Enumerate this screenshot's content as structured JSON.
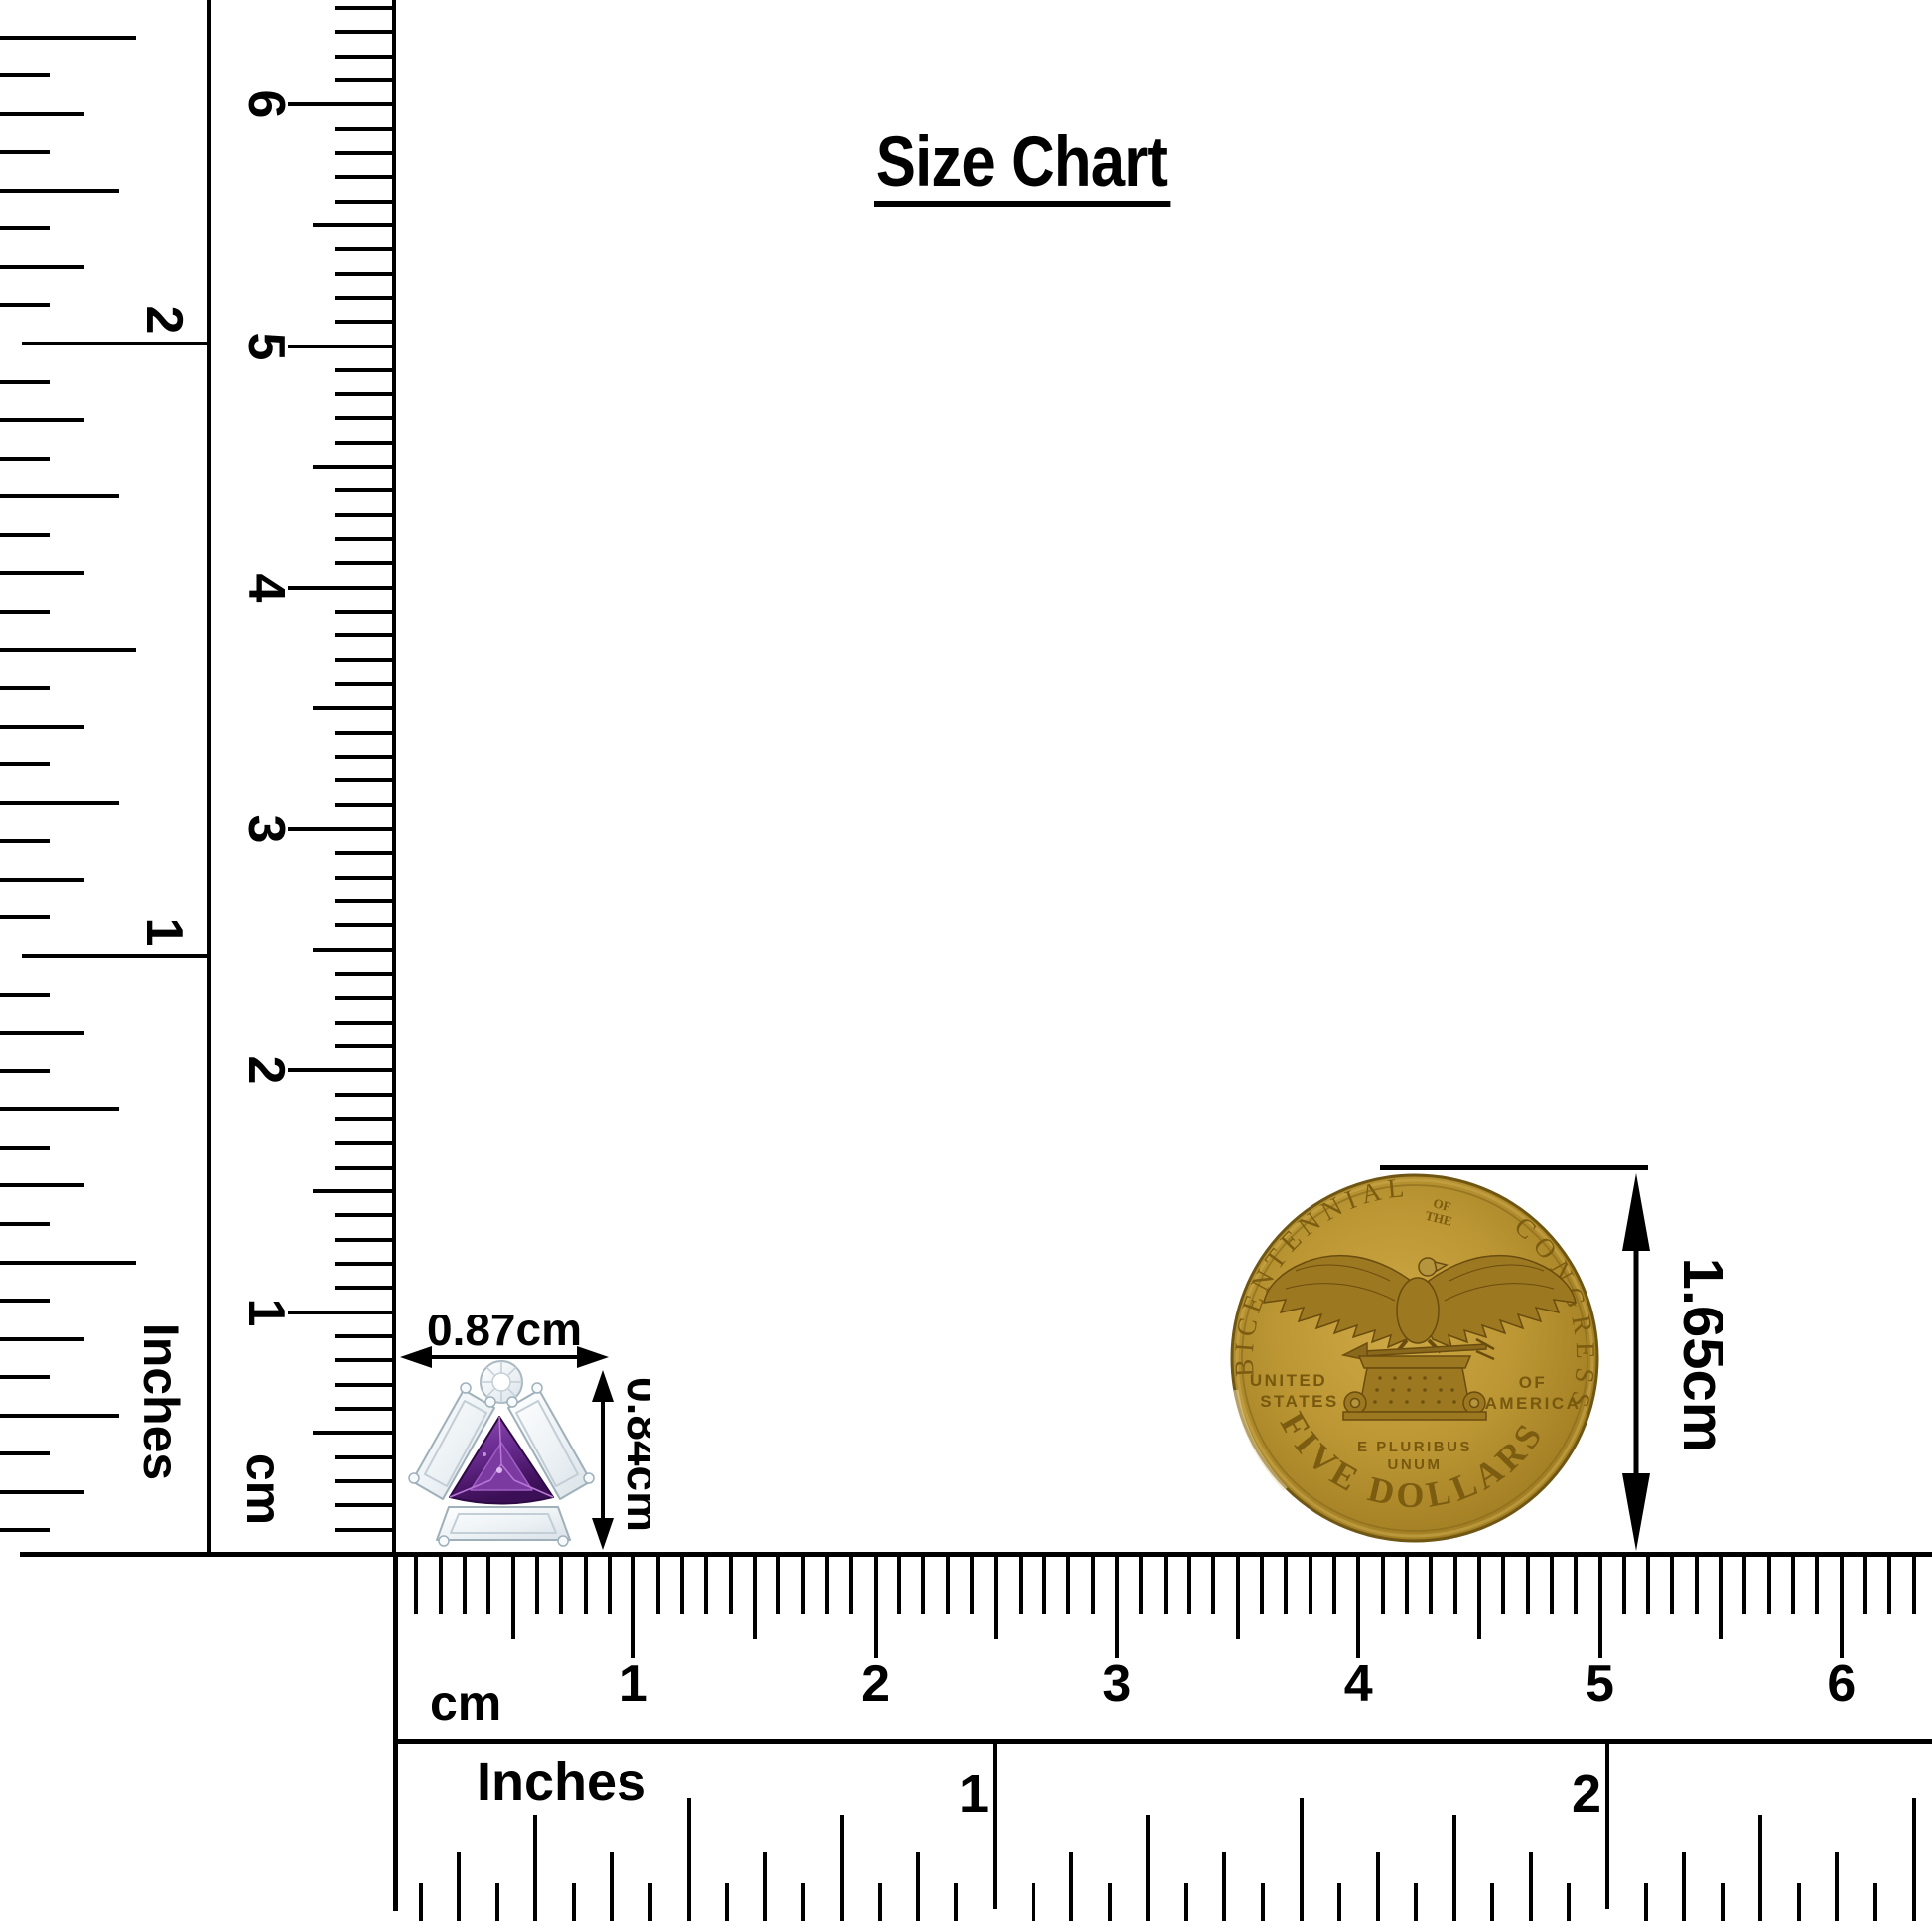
{
  "title": {
    "text": "Size Chart"
  },
  "rulers": {
    "left_inches": {
      "unit_label": "Inches",
      "numbers": [
        "1",
        "2"
      ]
    },
    "left_cm": {
      "unit_label": "cm",
      "numbers": [
        "1",
        "2",
        "3",
        "4",
        "5",
        "6"
      ]
    },
    "bottom_cm": {
      "unit_label": "cm",
      "numbers": [
        "1",
        "2",
        "3",
        "4",
        "5",
        "6"
      ]
    },
    "bottom_inches": {
      "unit_label": "Inches",
      "numbers": [
        "1",
        "2"
      ]
    }
  },
  "items": {
    "earring": {
      "name": "amethyst and diamond stud earring",
      "width_label": "0.87cm",
      "height_label": "0.84cm",
      "stone_color": "#7b3aa0",
      "accent_stone_color": "#f0f4f7"
    },
    "coin": {
      "name": "Congress Bicentennial five dollar gold coin",
      "height_label": "1.65cm",
      "gold_color": "#b08a2c",
      "inscriptions": {
        "top_left_arc": "BICENTENNIAL",
        "top_center_small": [
          "OF",
          "THE"
        ],
        "top_right_arc": "CONGRESS",
        "left_lines": [
          "UNITED",
          "STATES"
        ],
        "right_lines": [
          "OF",
          "AMERICA"
        ],
        "motto_lines": [
          "E PLURIBUS",
          "UNUM"
        ],
        "bottom_arc": "FIVE DOLLARS"
      }
    }
  }
}
